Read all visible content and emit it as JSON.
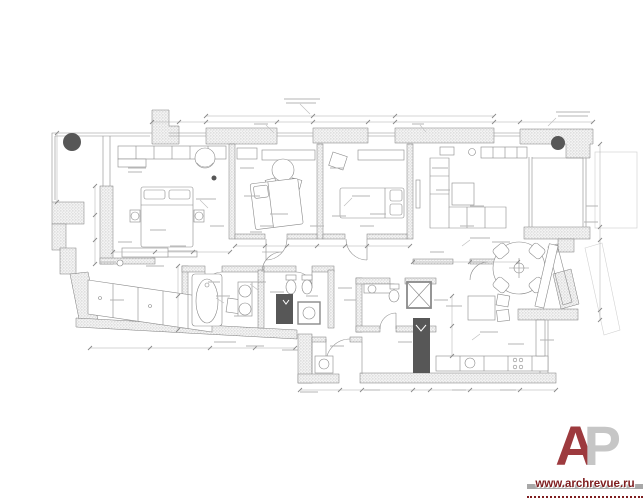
{
  "watermark": {
    "logo": {
      "letter_primary": "A",
      "letter_secondary": "P",
      "primary_color": "#9d3a3e",
      "secondary_color": "#c6c6c6"
    },
    "site_url": "www.archrevue.ru",
    "url_color": "#7e1d1f"
  },
  "drawing": {
    "type": "apartment-furniture-floor-plan",
    "background": "#ffffff",
    "line_color": "#7d7d7d",
    "wall_hatch_color": "#9a9a9a",
    "column_color": "#575757",
    "shaft_color": "#575757",
    "dimension_line_color": "#ababab",
    "areas": [
      {
        "name": "terrace",
        "features": [
          "round-column"
        ]
      },
      {
        "name": "master-bedroom",
        "features": [
          "wardrobe-run",
          "double-bed",
          "nightstands",
          "table-lamps",
          "round-armchair",
          "low-cabinet"
        ]
      },
      {
        "name": "kids-bedroom-1",
        "features": [
          "tilted-bed",
          "desk-shelf",
          "round-table",
          "two-chairs",
          "cabinet"
        ]
      },
      {
        "name": "kids-bedroom-2",
        "features": [
          "bed",
          "shelf-run",
          "tilted-armchair"
        ]
      },
      {
        "name": "living-room",
        "features": [
          "corner-sofa",
          "coffee-table",
          "wardrobe-run",
          "tv-panel",
          "lamp"
        ]
      },
      {
        "name": "balcony",
        "features": [
          "round-column",
          "glazing"
        ]
      },
      {
        "name": "dining-area",
        "features": [
          "round-table",
          "four-chairs",
          "tilted-cabinet"
        ]
      },
      {
        "name": "entrance-hall",
        "features": [
          "console",
          "wardrobe-row",
          "pouf"
        ]
      },
      {
        "name": "bathroom",
        "features": [
          "bathtub",
          "two-washbasins",
          "vanity-counter",
          "ventilation-shaft"
        ]
      },
      {
        "name": "wc",
        "features": [
          "toilet",
          "bidet",
          "washing-machine"
        ]
      },
      {
        "name": "guest-wc",
        "features": [
          "washbasin-counter",
          "wall-hung-toilet",
          "shower-box"
        ]
      },
      {
        "name": "kitchen",
        "features": [
          "counter-run",
          "sink",
          "cooktop",
          "breakfast-table",
          "two-chairs",
          "ventilation-shaft",
          "tall-cabinet"
        ]
      },
      {
        "name": "entry-vestibule",
        "features": [
          "entry-door",
          "washing-machine"
        ]
      }
    ]
  }
}
